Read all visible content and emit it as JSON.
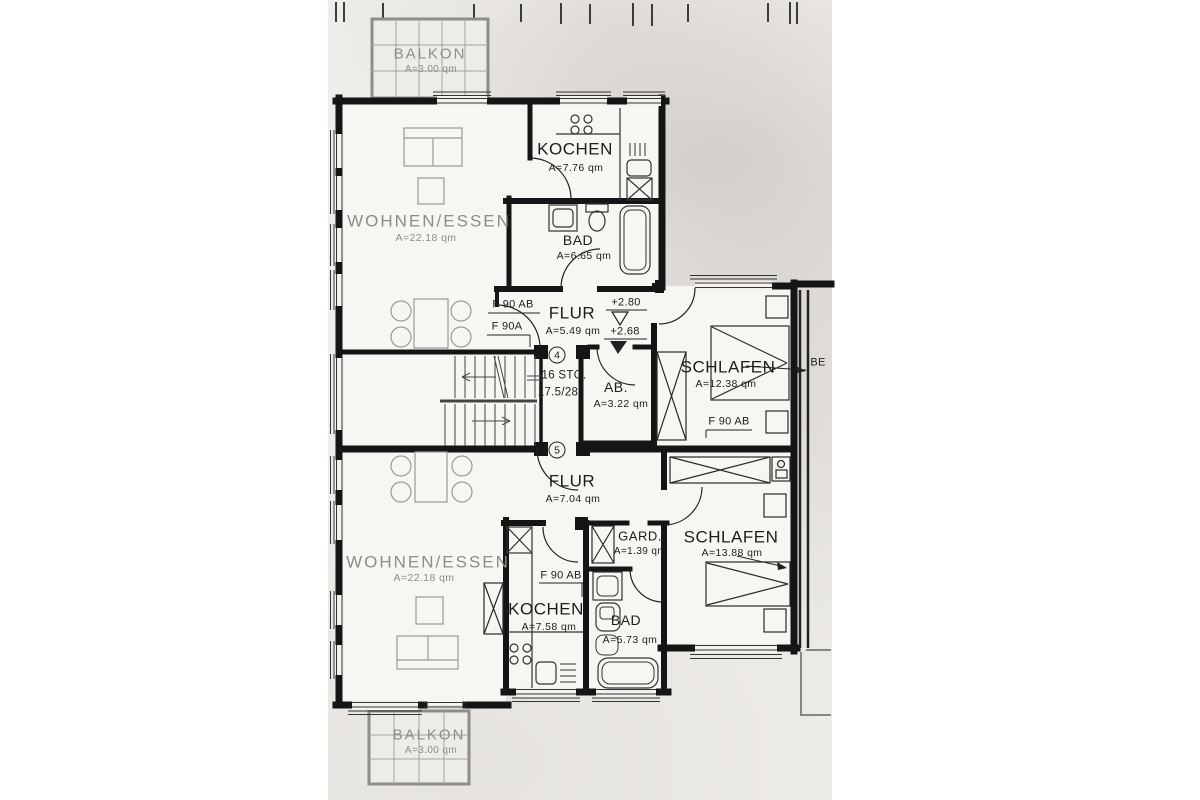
{
  "plan": {
    "unit_top": {
      "balkon_label": "BALKON",
      "balkon_area": "A=3.00 qm",
      "wohnen_label": "WOHNEN/ESSEN",
      "wohnen_area": "A=22.18 qm",
      "kochen_label": "KOCHEN",
      "kochen_area": "A=7.76 qm",
      "bad_label": "BAD",
      "bad_area": "A=6.65 qm",
      "flur_label": "FLUR",
      "flur_area": "A=5.49 qm",
      "ab_label": "AB.",
      "ab_area": "A=3.22 qm",
      "schlafen_label": "SCHLAFEN",
      "schlafen_area": "A=12.38 qm",
      "door_label_1": "F 90 AB",
      "door_label_2": "F 90A",
      "schlafen_door_label": "F 90 AB"
    },
    "unit_bottom": {
      "flur_label": "FLUR",
      "flur_area": "A=7.04 qm",
      "gard_label": "GARD.",
      "gard_area": "A=1.39 qm",
      "wohnen_label": "WOHNEN/ESSEN",
      "wohnen_area": "A=22.18 qm",
      "kochen_label": "KOCHEN",
      "kochen_area": "A=7.58 qm",
      "kochen_door_label": "F 90 AB",
      "bad_label": "BAD",
      "bad_area": "A=5.73 qm",
      "schlafen_label": "SCHLAFEN",
      "schlafen_area": "A=13.88 qm",
      "balkon_label": "BALKON",
      "balkon_area": "A=3.00 qm"
    },
    "stairs": {
      "marker_top": "4",
      "marker_bottom": "5",
      "steps": "16 STG.",
      "riser_tread": "17.5/28"
    },
    "levels": {
      "upper": "+2.80",
      "lower": "+2.68"
    },
    "edge_label": "BE",
    "ink_color": "#1d1d1d",
    "paper_color": "#efede9"
  }
}
